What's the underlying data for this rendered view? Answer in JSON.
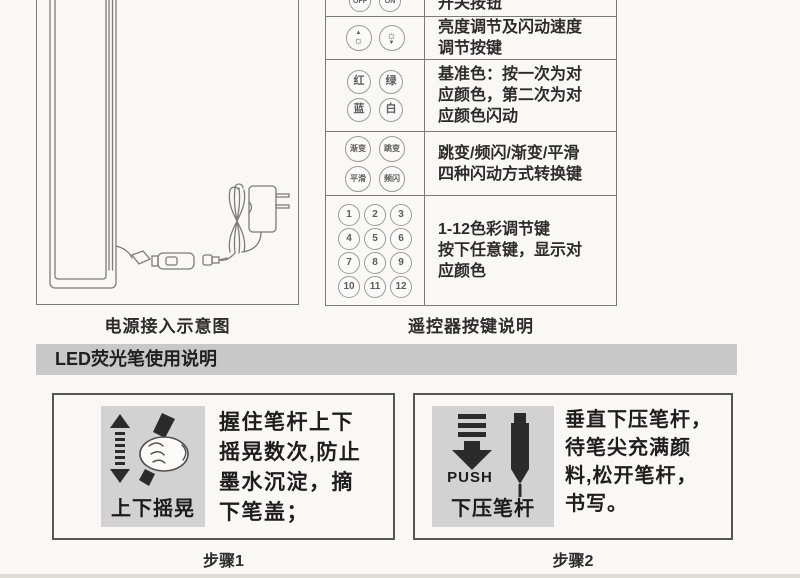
{
  "power_diagram": {
    "caption": "电源接入示意图"
  },
  "remote": {
    "caption": "遥控器按键说明",
    "icons": {
      "up": "▲",
      "down": "▼",
      "sun": "☼"
    },
    "rows": [
      {
        "buttons": [
          "OFF",
          "ON"
        ],
        "desc": "开关按钮"
      },
      {
        "desc": "亮度调节及闪动速度\n调节按键"
      },
      {
        "buttons": [
          "红",
          "绿",
          "蓝",
          "白"
        ],
        "desc": "基准色：按一次为对\n应颜色，第二次为对\n应颜色闪动"
      },
      {
        "buttons": [
          "渐变",
          "跳变",
          "平滑",
          "频闪"
        ],
        "desc": "跳变/频闪/渐变/平滑\n四种闪动方式转换键"
      },
      {
        "buttons": [
          "1",
          "2",
          "3",
          "4",
          "5",
          "6",
          "7",
          "8",
          "9",
          "10",
          "11",
          "12"
        ],
        "desc": "1-12色彩调节键\n按下任意键，显示对\n应颜色"
      }
    ]
  },
  "section": {
    "header": "LED荧光笔使用说明"
  },
  "steps": [
    {
      "caption": "步骤1",
      "icon_label": "上下摇晃",
      "text": "握住笔杆上下\n摇晃数次,防止\n墨水沉淀，摘\n下笔盖；"
    },
    {
      "caption": "步骤2",
      "icon_label": "下压笔杆",
      "push": "PUSH",
      "text": "垂直下压笔杆，\n待笔尖充满颜\n料,松开笔杆，\n书写。"
    }
  ],
  "colors": {
    "band_bg": "#c8c8c8",
    "square_bg": "#d2d2d2",
    "page_bg": "#f9f8f5",
    "line": "#7a7a7a",
    "ink": "#2b2b2b"
  }
}
